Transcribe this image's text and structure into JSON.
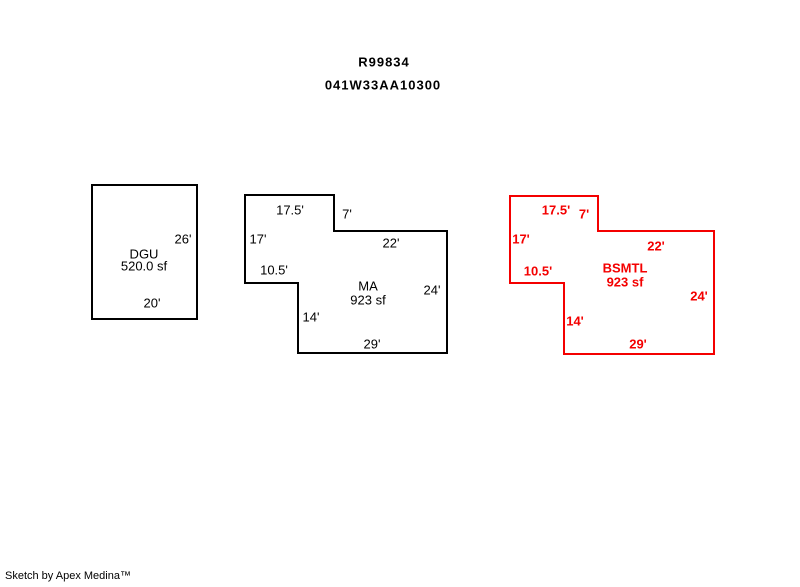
{
  "title": {
    "record_id": "R99834",
    "parcel_id": "041W33AA10300"
  },
  "footer": {
    "credit": "Sketch by Apex Medina™"
  },
  "colors": {
    "main": "#000000",
    "basement": "#f40000",
    "background": "#ffffff"
  },
  "sketch": {
    "dgu": {
      "name": "DGU",
      "area": "520.0 sf",
      "points": "92,185 197,185 197,319 92,319",
      "dims": {
        "right": "26'",
        "bottom": "20'"
      }
    },
    "ma": {
      "name": "MA",
      "area": "923 sf",
      "points": "245,195 334,195 334,231 447,231 447,353 298,353 298,283 245,283",
      "dims": {
        "top": "17.5'",
        "notch": "7'",
        "left": "17'",
        "upper_right": "22'",
        "step": "10.5'",
        "right": "24'",
        "lower_left": "14'",
        "bottom": "29'"
      }
    },
    "bsmtl": {
      "name": "BSMTL",
      "area": "923 sf",
      "points": "510,196 598,196 598,231 714,231 714,354 564,354 564,283 510,283",
      "dims": {
        "top": "17.5'",
        "notch": "7'",
        "left": "17'",
        "upper_right": "22'",
        "step": "10.5'",
        "right": "24'",
        "lower_left": "14'",
        "bottom": "29'"
      }
    }
  }
}
